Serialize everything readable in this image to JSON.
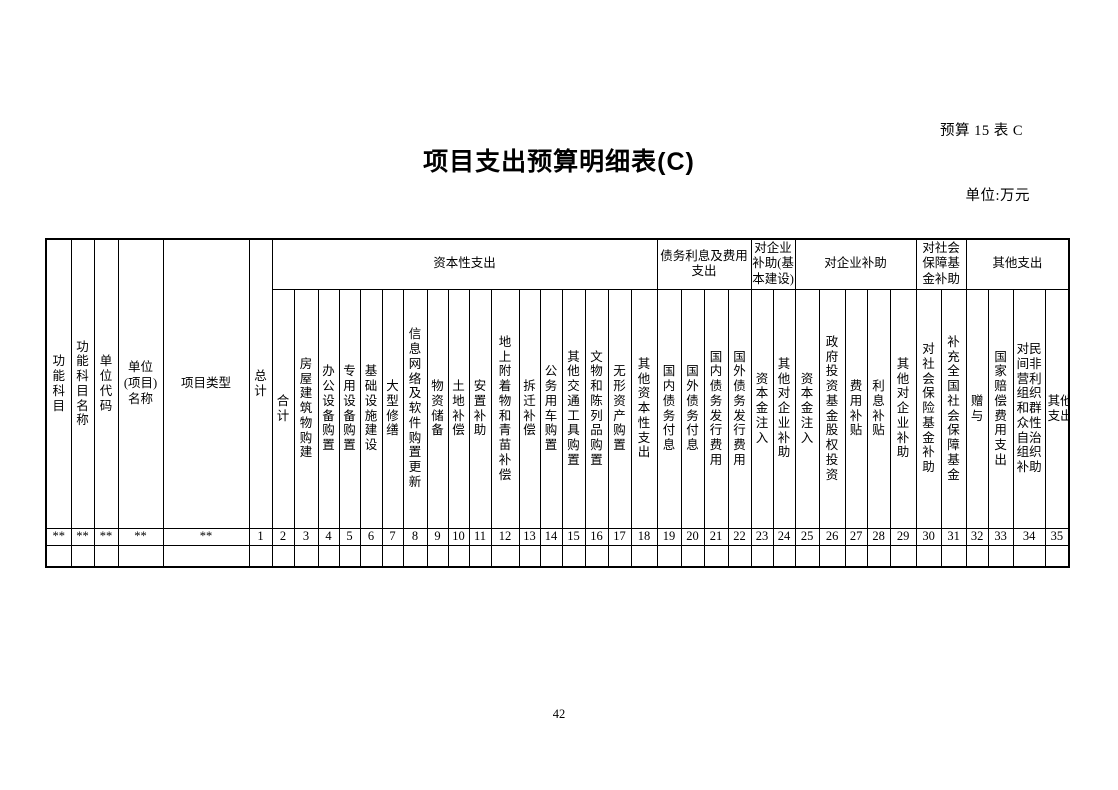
{
  "page": {
    "form_code": "预算 15 表 C",
    "title": "项目支出预算明细表(C)",
    "unit": "单位:万元",
    "page_number": "42"
  },
  "table": {
    "left_columns": [
      {
        "label": "功能科目",
        "value": "**"
      },
      {
        "label": "功能科目名称",
        "value": "**"
      },
      {
        "label": "单位代码",
        "value": "**"
      },
      {
        "label": "单位\n(项目)\n名称",
        "value": "**"
      },
      {
        "label": "项目类型",
        "value": "**"
      }
    ],
    "groups": [
      {
        "label": "资本性支出",
        "span": 17
      },
      {
        "label": "债务利息及费用\n支出",
        "span": 4
      },
      {
        "label": "对企业\n补助(基\n本建设)",
        "span": 2
      },
      {
        "label": "对企业补助",
        "span": 5
      },
      {
        "label": "对社会\n保障基\n金补助",
        "span": 2
      },
      {
        "label": "其他支出",
        "span": 4
      }
    ],
    "columns": [
      {
        "num": "1",
        "label": "总计"
      },
      {
        "num": "2",
        "label": "合计"
      },
      {
        "num": "3",
        "label": "房屋建筑物购建"
      },
      {
        "num": "4",
        "label": "办公设备购置"
      },
      {
        "num": "5",
        "label": "专用设备购置"
      },
      {
        "num": "6",
        "label": "基础设施建设"
      },
      {
        "num": "7",
        "label": "大型修缮"
      },
      {
        "num": "8",
        "label": "信息网络及软件购置更新"
      },
      {
        "num": "9",
        "label": "物资储备"
      },
      {
        "num": "10",
        "label": "土地补偿"
      },
      {
        "num": "11",
        "label": "安置补助"
      },
      {
        "num": "12",
        "label": "地上附着物和青苗补偿"
      },
      {
        "num": "13",
        "label": "拆迁补偿"
      },
      {
        "num": "14",
        "label": "公务用车购置"
      },
      {
        "num": "15",
        "label": "其他交通工具购置"
      },
      {
        "num": "16",
        "label": "文物和陈列品购置"
      },
      {
        "num": "17",
        "label": "无形资产购置"
      },
      {
        "num": "18",
        "label": "其他资本性支出"
      },
      {
        "num": "19",
        "label": "国内债务付息"
      },
      {
        "num": "20",
        "label": "国外债务付息"
      },
      {
        "num": "21",
        "label": "国内债务发行费用"
      },
      {
        "num": "22",
        "label": "国外债务发行费用"
      },
      {
        "num": "23",
        "label": "资本金注入"
      },
      {
        "num": "24",
        "label": "其他对企业补助"
      },
      {
        "num": "25",
        "label": "资本金注入"
      },
      {
        "num": "26",
        "label": "政府投资基金股权投资"
      },
      {
        "num": "27",
        "label": "费用补贴"
      },
      {
        "num": "28",
        "label": "利息补贴"
      },
      {
        "num": "29",
        "label": "其他对企业补助"
      },
      {
        "num": "30",
        "label": "对社会保险基金补助"
      },
      {
        "num": "31",
        "label": "补充全国社会保障基金"
      },
      {
        "num": "32",
        "label": "赠与"
      },
      {
        "num": "33",
        "label": "国家赔偿费用支出"
      },
      {
        "num": "34",
        "label": "对民间非营利组织和群众性自治组织补助"
      },
      {
        "num": "35",
        "label": "其他支出"
      }
    ]
  }
}
